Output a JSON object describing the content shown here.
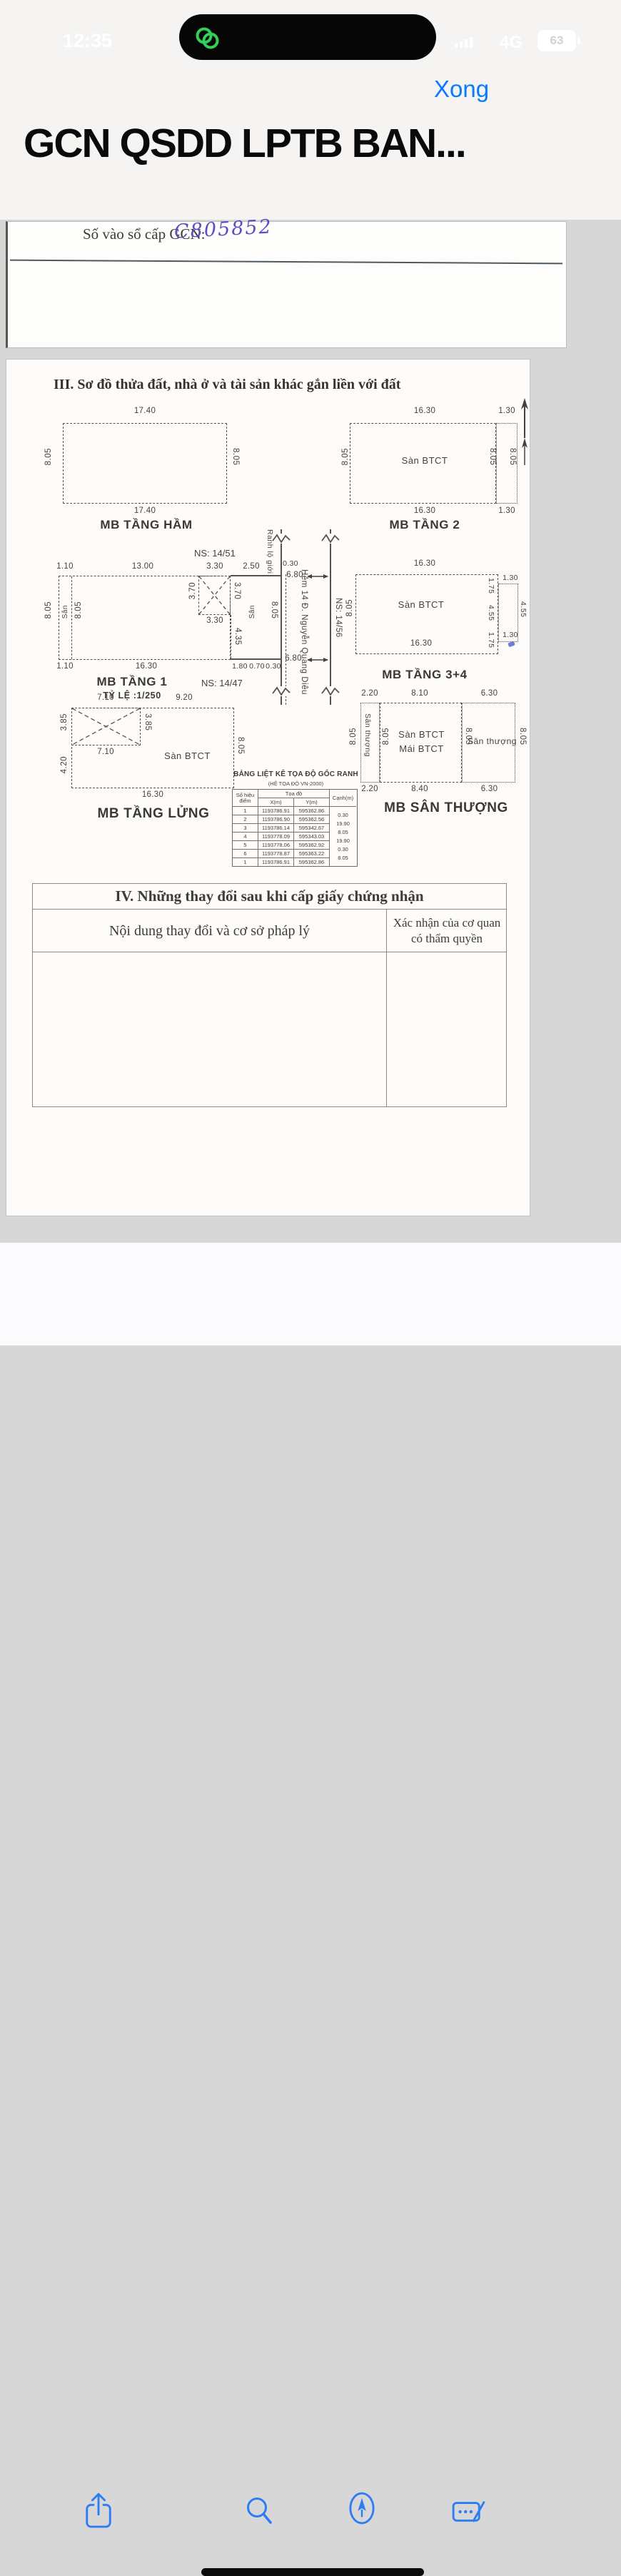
{
  "status_bar": {
    "time": "12:35",
    "network": "4G",
    "battery_percent": "63"
  },
  "nav": {
    "done_label": "Xong",
    "doc_title": "GCN QSDD LPTB BAN..."
  },
  "registry_line": {
    "label": "Số vào sổ cấp GCN:",
    "value": "C805852"
  },
  "section3": {
    "heading": "III. Sơ đồ thửa đất, nhà ở và tài sản khác gắn liền với đất"
  },
  "plans": {
    "ham": {
      "caption": "MB TẦNG HẦM",
      "top": "17.40",
      "bottom": "17.40",
      "left": "8.05",
      "right": "8.05"
    },
    "t2": {
      "caption": "MB TẦNG 2",
      "label": "Sàn BTCT",
      "top": "16.30",
      "bottom": "16.30",
      "left": "8.05",
      "right_inner": "8.05",
      "right_outer": "8.05",
      "strip_top": "1.30",
      "strip_bottom": "1.30"
    },
    "t1": {
      "caption": "MB TẦNG 1",
      "scale": "TỶ LỆ :1/250",
      "ns_top": "NS: 14/51",
      "ns_label": "NS: 14/47",
      "top": [
        "1.10",
        "13.00",
        "3.30",
        "2.50"
      ],
      "bottom": [
        "1.10",
        "16.30",
        "1.80",
        "0.70",
        "0.30"
      ],
      "left_outer": "8.05",
      "left_inner": "8.05",
      "san": "Sân",
      "san_right": "Sân",
      "right_inner": "8.05",
      "x_left": "3.70",
      "x_right": "3.70",
      "x_bottom": "3.30",
      "below": "4.35",
      "jog": "0.30"
    },
    "road": {
      "boundary": "Ranh lộ giới",
      "name": "Hẻm 14 Đ. Nguyễn Quang Diêu",
      "ns": "NS: 14/56",
      "width_top": "6.80",
      "width_bottom": "6.80"
    },
    "t34": {
      "caption": "MB TẦNG 3+4",
      "label": "Sàn BTCT",
      "top": "16.30",
      "bottom": "16.30",
      "left": "8.05",
      "right_inner": [
        "1.75",
        "4.55",
        "1.75"
      ],
      "right_outer": [
        "1.30",
        "4.55",
        "1.30"
      ]
    },
    "lung": {
      "caption": "MB TẦNG LỬNG",
      "top_a": "7.10",
      "top_b": "9.20",
      "left_a": "3.85",
      "left_b": "4.20",
      "x_right": "3.85",
      "x_bottom": "7.10",
      "label": "Sàn BTCT",
      "right": "8.05",
      "bottom": "16.30"
    },
    "st": {
      "caption": "MB SÂN THƯỢNG",
      "top": [
        "2.20",
        "8.10",
        "6.30"
      ],
      "bottom": [
        "2.20",
        "8.40",
        "6.30"
      ],
      "left_label": "Sân thượng",
      "right_label": "Sân thượng",
      "left_outer": "8.05",
      "mid_left": "8.05",
      "mid_right": "8.05",
      "right_outer": "8.05",
      "label_a": "Sàn BTCT",
      "label_b": "Mái BTCT"
    }
  },
  "coord_table": {
    "title": "BẢNG LIỆT KÊ TỌA ĐỘ GỐC RANH",
    "subtitle": "(HỆ TỌA ĐỘ VN-2000)",
    "col_point": "Số hiệu điểm",
    "col_group": "Tọa độ",
    "col_x": "X(m)",
    "col_y": "Y(m)",
    "col_edge": "Cạnh(m)",
    "rows": [
      {
        "p": "1",
        "x": "1193786.91",
        "y": "595362.86"
      },
      {
        "p": "2",
        "x": "1193786.90",
        "y": "595362.56"
      },
      {
        "p": "3",
        "x": "1193786.14",
        "y": "595342.67"
      },
      {
        "p": "4",
        "x": "1193778.09",
        "y": "595343.03"
      },
      {
        "p": "5",
        "x": "1193778.06",
        "y": "595362.92"
      },
      {
        "p": "6",
        "x": "1193778.87",
        "y": "595363.22"
      },
      {
        "p": "1",
        "x": "1193786.91",
        "y": "595362.86"
      }
    ],
    "edges": [
      "0.30",
      "19.90",
      "8.05",
      "19.90",
      "0.30",
      "8.05"
    ]
  },
  "section4": {
    "heading": "IV. Những thay đổi sau khi cấp giấy chứng nhận",
    "col_left": "Nội dung thay đổi và cơ sở pháp lý",
    "col_right": "Xác nhận của cơ quan có thẩm quyền"
  },
  "toolbar": {
    "icons": [
      "share",
      "search",
      "markup",
      "signature"
    ]
  }
}
